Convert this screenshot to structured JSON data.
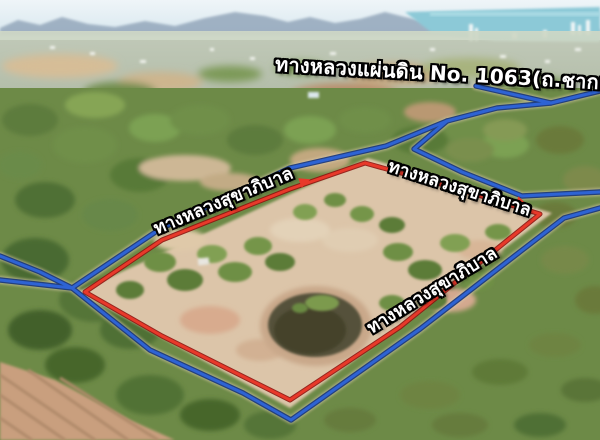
{
  "labels": {
    "national_highway": "ทางหลวงแผ่นดิน No. 1063(ถ.ชากแง้ว)",
    "municipal_road": "ทางหลวงสุขาภิบาล"
  },
  "colors": {
    "road_line_blue": "#2e63d4",
    "boundary_line_red": "#e8392a",
    "label_text": "#ffffff",
    "label_outline": "#000000"
  }
}
